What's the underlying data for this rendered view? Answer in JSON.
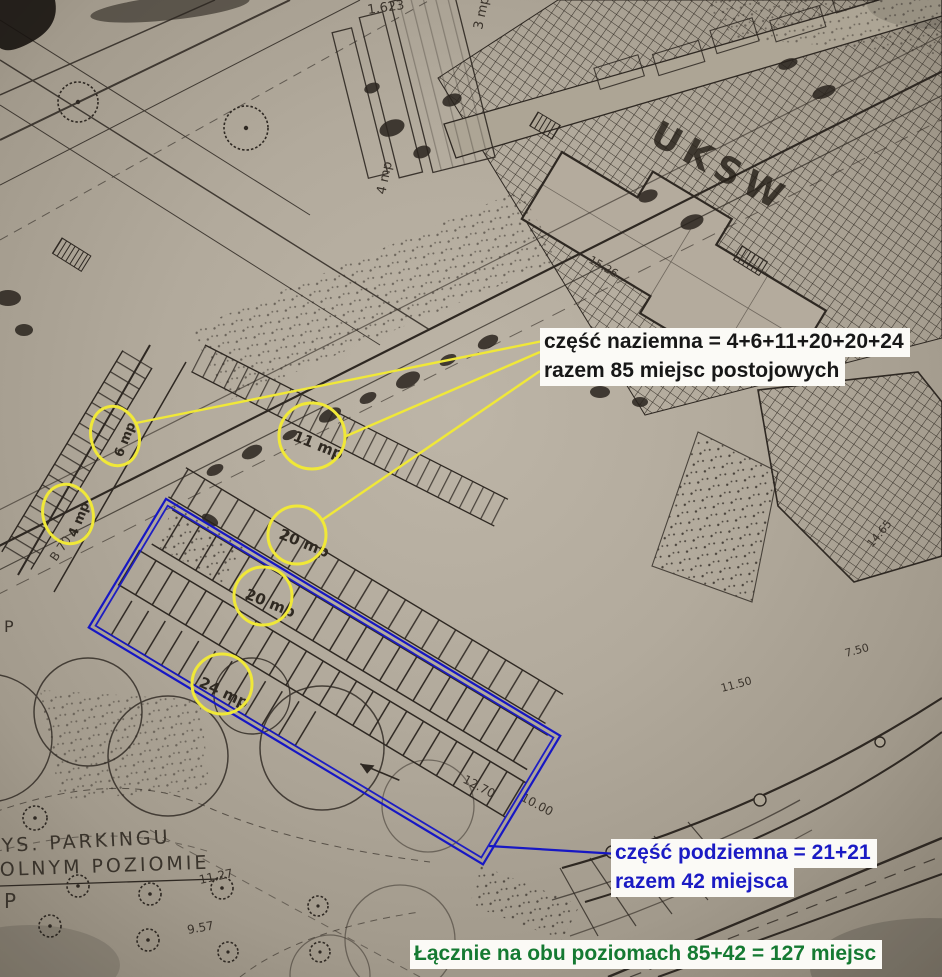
{
  "annotations": {
    "above_ground": {
      "line1": "część naziemna = 4+6+11+20+20+24",
      "line2": "razem 85 miejsc postojowych"
    },
    "underground": {
      "line1": "część podziemna = 21+21",
      "line2": "razem 42 miejsca"
    },
    "total": {
      "line1": "Łącznie na obu poziomach 85+42 = 127 miejsc"
    }
  },
  "map": {
    "campus_label": "UKSW",
    "caption": {
      "line1": "YS. PARKINGU",
      "line2": "OLNYM POZIOMIE",
      "p": "P"
    },
    "spots": [
      {
        "label": "6 mp"
      },
      {
        "label": "4 mp"
      },
      {
        "label": "11 mp"
      },
      {
        "label": "20 mp"
      },
      {
        "label": "20 mp"
      },
      {
        "label": "24 mp"
      }
    ],
    "numbers": [
      "1.623",
      "3 mp",
      "4 mp",
      "15.26",
      "14.65",
      "11.50",
      "7.50",
      "12.70",
      "10.00",
      "11.27",
      "9.57",
      "B 70",
      "P"
    ]
  },
  "colors": {
    "highlight_yellow": "#f0e838",
    "outline_blue": "#1717c4",
    "text_blue": "#1b1bc4",
    "text_green": "#157a32",
    "text_black": "#171717",
    "paper": "#b1a89a",
    "ink": "#2e2822"
  }
}
